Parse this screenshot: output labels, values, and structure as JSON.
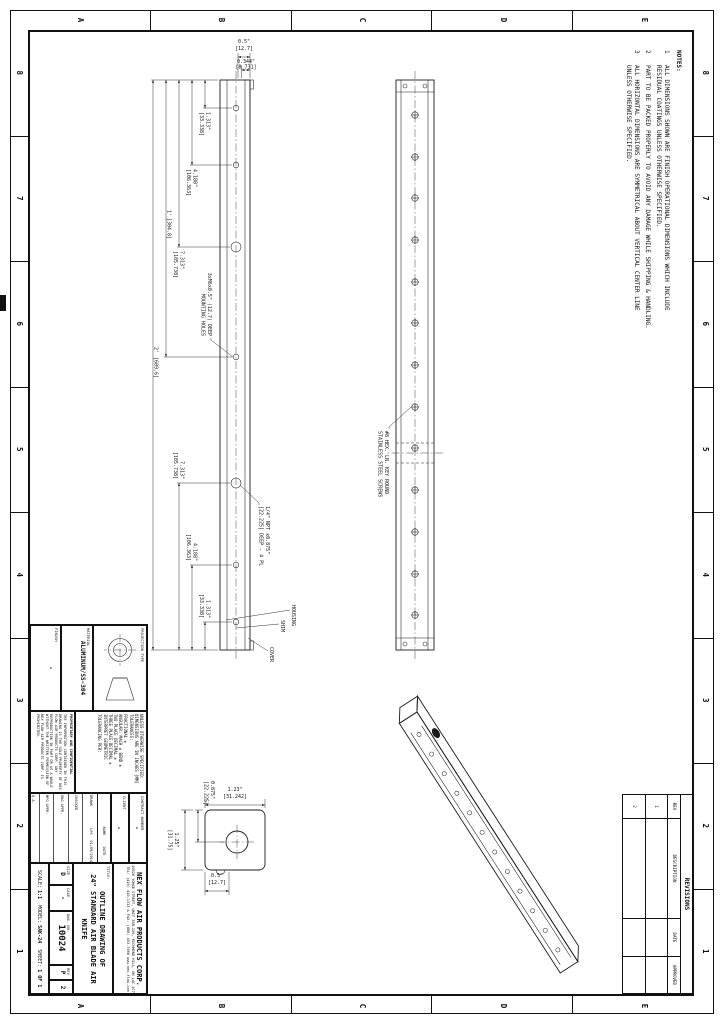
{
  "zones": {
    "cols": [
      "8",
      "7",
      "6",
      "5",
      "4",
      "3",
      "2",
      "1"
    ],
    "rows": [
      "E",
      "D",
      "C",
      "B",
      "A"
    ]
  },
  "notes": {
    "heading": "NOTES:",
    "items": [
      {
        "num": "1",
        "text": "ALL DIMENSIONS SHOWN ARE FINISH OPERATIONAL DIMENSIONS WHICH INCLUDE\nRESIDUAL COATINGS UNLESS OTHERWISE SPECIFIED."
      },
      {
        "num": "2",
        "text": "PART TO BE PACKED PROPERLY TO AVOID ANY DAMAGE WHILE SHIPPING & HANDLING."
      },
      {
        "num": "3",
        "text": "ALL HORIZONTAL DIMENSIONS ARE SYMMETRICAL ABOUT VERTICAL CENTER LINE\nUNLESS OTHERWISE SPECIFIED."
      }
    ]
  },
  "revisions": {
    "title": "REVISIONS",
    "headers": [
      "REV",
      "DESCRIPTION",
      "DATE",
      "APPROVED"
    ],
    "rows": [
      {
        "rev": "1",
        "description": "",
        "date": "",
        "approved": ""
      },
      {
        "rev": "2",
        "description": "",
        "date": "",
        "approved": ""
      }
    ]
  },
  "title_block": {
    "projection_label": "PROJECTION TYPE",
    "material_label": "MATERIAL",
    "material": "ALUMINUM/SS-304",
    "finish_label": "FINISH",
    "finish": "-",
    "tolerance_note": "UNLESS OTHERWISE SPECIFIED:\nDIMENSIONS ARE IN INCHES [MM]\nTOLERANCES:\nFRACTIONAL ±\nANGULAR: MACH ± BEND ±\nTWO PLACE DECIMAL ±\nTHREE PLACE DECIMAL ±\nINTERPRET GEOMETRIC\nTOLERANCING PER:",
    "proprietary_head": "PROPRIETARY AND CONFIDENTIAL",
    "proprietary_body": "THE INFORMATION CONTAINED IN THIS DRAWING IS THE SOLE PROPERTY OF NEX FLOW AIR PRODUCTS CORP. ANY REPRODUCTION IN PART OR AS A WHOLE WITHOUT THE WRITTEN PERMISSION OF NEX FLOW AIR PRODUCTS CORP. IS PROHIBITED.",
    "contract_label": "CONTRACT NUMBER",
    "contract": "-",
    "client_label": "CLIENT",
    "client": "-",
    "approval": {
      "name_h": "NAME",
      "date_h": "DATE",
      "rows": [
        {
          "label": "DRAWN",
          "name": "LPS",
          "date": "01/09/2014"
        },
        {
          "label": "CHECKED",
          "name": "",
          "date": ""
        },
        {
          "label": "ENG APPR.",
          "name": "",
          "date": ""
        },
        {
          "label": "MFG APPR.",
          "name": "",
          "date": ""
        },
        {
          "label": "Q.A.",
          "name": "",
          "date": ""
        }
      ]
    },
    "company": {
      "name": "NEX FLOW AIR PRODUCTS CORP.",
      "address": "10520 YONGE STREET, UNIT 35B-220, RICHMOND HILL, ON L4C 3C7",
      "contact": "TEL: (416) 410-1313 & FAX: (888) 453-7008   www.nex-flow.com"
    },
    "title_label": "TITLE:",
    "title_line1": "OUTLINE DRAWING OF",
    "title_line2": "24\" STANDARD AIR BLADE AIR KNIFE",
    "size_label": "SIZE",
    "size": "D",
    "cage_label": "CAGE",
    "cage": "-",
    "dwg_label": "DWG. NO.",
    "dwg_no": "10024",
    "rev_label": "REV",
    "rev_p": "P",
    "rev_n": "2",
    "scale_label": "SCALE:",
    "scale": "1:1",
    "model_label": "MODEL:",
    "model": "SAK-24",
    "sheet_label": "SHEET:",
    "sheet": "1 OF 1"
  },
  "views": {
    "top": {
      "dims": {
        "offset_in": "0.5\"",
        "offset_mm": "[12.7]",
        "hole_offset_in": "0.344\"",
        "hole_offset_mm": "[8.731]",
        "hole1_in": "1.313\"",
        "hole1_mm": "[33.338]",
        "hole2_in": "4.188\"",
        "hole2_mm": "[106.363]",
        "hole3_in": "7.313\"",
        "hole3_mm": "[185.738]",
        "half_in": "1'",
        "half_mm": "[304.8]",
        "full_in": "2'",
        "full_mm": "[609.6]"
      },
      "labels": {
        "mounting_1": "3xM6x0.5\" (12.7) DEEP",
        "mounting_2": "MOUNTING HOLES",
        "npt_1": "1/4\" NPT x0.875\"",
        "npt_2": "[22.225] DEEP - 4 PL",
        "cover": "COVER",
        "shim": "SHIM",
        "housing": "HOUSING"
      }
    },
    "face": {
      "labels": {
        "screws_1": "#8 HEX. LN. KEY ROUND",
        "screws_2": "STAINLESS STEEL SCREWS"
      }
    },
    "section": {
      "dims": {
        "width_in": "1.23\"",
        "width_mm": "[31.242]",
        "slot_in": "0.875\"",
        "slot_mm": "[22.225]",
        "height_in": "1.25\"",
        "height_mm": "[31.75]",
        "offset_in": "0.5\"",
        "offset_mm": "[12.7]"
      }
    }
  }
}
